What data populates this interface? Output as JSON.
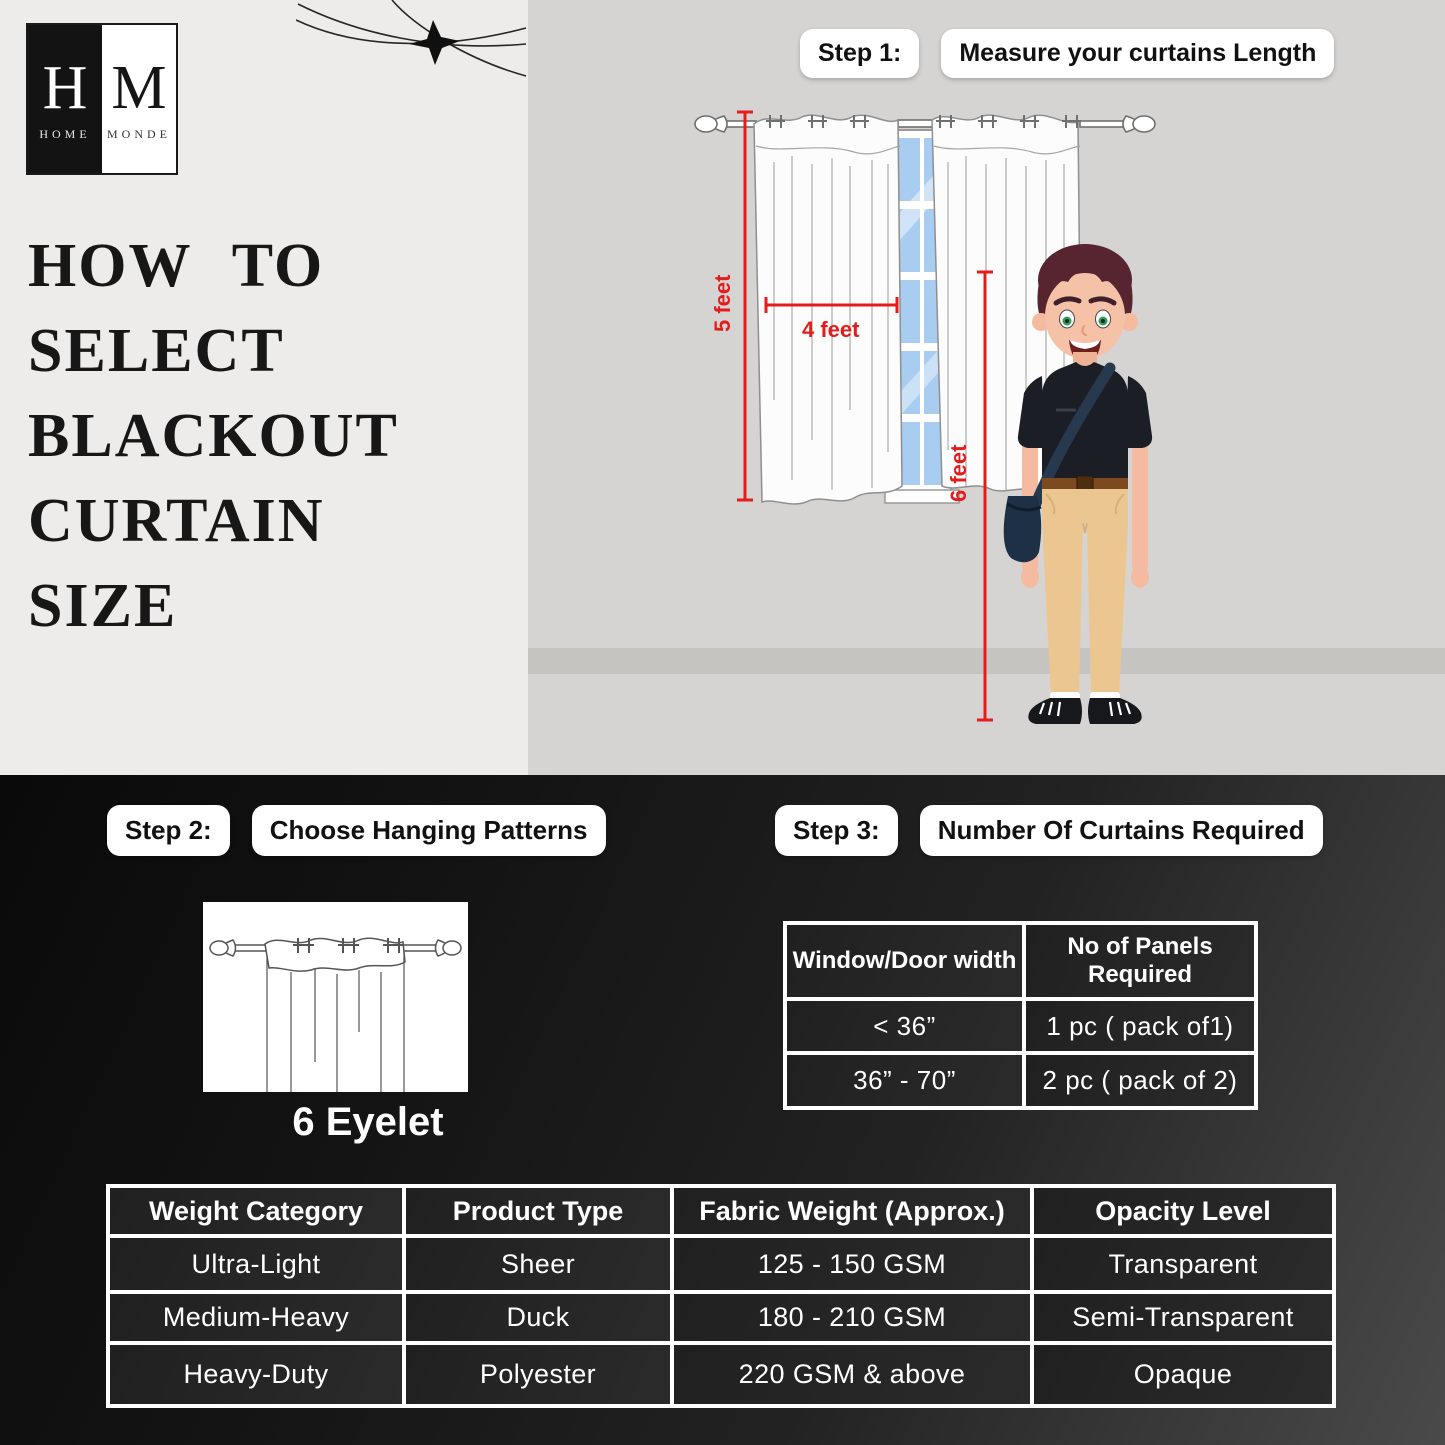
{
  "brand": {
    "initial_left": "H",
    "initial_right": "M",
    "word_left": "HOME",
    "word_right": "MONDE"
  },
  "title_lines": [
    "HOW TO",
    "SELECT",
    "BLACKOUT",
    "CURTAIN",
    "SIZE"
  ],
  "step1": {
    "label": "Step 1:",
    "caption": "Measure your curtains Length"
  },
  "step2": {
    "label": "Step 2:",
    "caption": "Choose Hanging Patterns"
  },
  "step3": {
    "label": "Step 3:",
    "caption": "Number Of Curtains Required"
  },
  "measurements": {
    "curtain_height": "5 feet",
    "curtain_width": "4 feet",
    "person_height": "6 feet"
  },
  "hanging_pattern_label": "6 Eyelet",
  "panels_table": {
    "col1_header": "Window/Door width",
    "col2_header": "No of Panels Required",
    "rows": [
      {
        "width": "< 36”",
        "panels": "1 pc ( pack of1)"
      },
      {
        "width": "36” - 70”",
        "panels": "2 pc ( pack of 2)"
      }
    ]
  },
  "fabric_table": {
    "headers": [
      "Weight Category",
      "Product Type",
      "Fabric Weight (Approx.)",
      "Opacity Level"
    ],
    "rows": [
      [
        "Ultra-Light",
        "Sheer",
        "125 - 150 GSM",
        "Transparent"
      ],
      [
        "Medium-Heavy",
        "Duck",
        "180 - 210 GSM",
        "Semi-Transparent"
      ],
      [
        "Heavy-Duty",
        "Polyester",
        "220 GSM & above",
        "Opaque"
      ]
    ]
  },
  "colors": {
    "accent_red": "#e31c1c",
    "panel_light": "#edecea",
    "panel_wall": "#d5d4d2",
    "wall_band": "#c5c4c1",
    "dark_bg": "#141414",
    "window_blue": "#a9cdf1"
  }
}
